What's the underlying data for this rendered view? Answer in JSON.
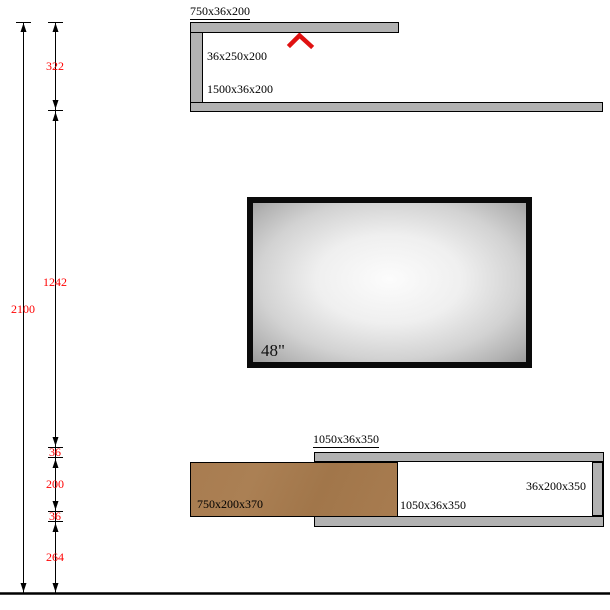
{
  "shelf_unit_top": {
    "top_panel_label": "750x36x200",
    "side_panel_label": "36x250x200",
    "bottom_panel_label": "1500x36x200"
  },
  "tv": {
    "size_label": "48\""
  },
  "cabinet_bottom": {
    "top_panel_label": "1050x36x350",
    "shelf_label": "1050x36x350",
    "side_panel_label": "36x200x350",
    "drawer_front_label": "750x200x370"
  },
  "dimensions": {
    "total_height": "2100",
    "segments": [
      "322",
      "1242",
      "36",
      "200",
      "36",
      "264"
    ]
  },
  "colors": {
    "panel_gray": "#b2b2b2",
    "wood_brown": "#a87c50",
    "dim_red": "#ff0000",
    "accent_red": "#e01111"
  }
}
